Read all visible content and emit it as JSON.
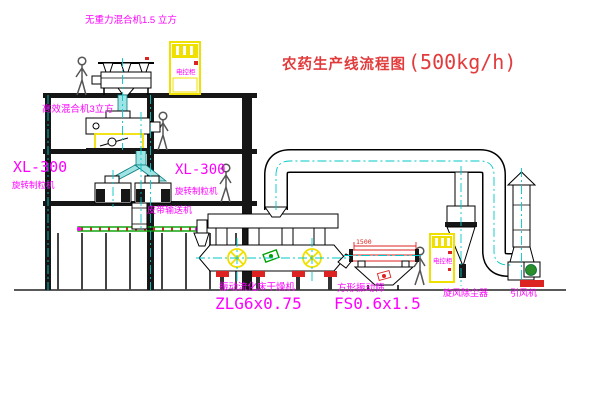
{
  "title": {
    "zh": "农药生产线流程图",
    "capacity": "(500kg/h)"
  },
  "labels": {
    "top_mixer": "无重力混合机1.5 立方",
    "floor2_mixer": "高效混合机3立方",
    "granulator1_model": "XL-300",
    "granulator1_name": "旋转制粒机",
    "granulator2_model": "XL-300",
    "granulator2_name": "旋转制粒机",
    "belt_conveyor": "皮带输送机",
    "dryer_name": "振动流化床干燥机",
    "dryer_model": "ZLG6x0.75",
    "sieve_name": "方形振动筛",
    "sieve_model": "FS0.6x1.5",
    "cyclone": "旋风除尘器",
    "fan": "引风机",
    "cabinet1": "电控柜",
    "cabinet2": "电控柜",
    "sieve_dimension": "1500"
  },
  "colors": {
    "label_magenta": "#ff00ff",
    "title_red": "#e23b3b",
    "dim_red": "#dd2222",
    "highlight_yellow": "#f0e000",
    "centerline_cyan": "#00c8c8",
    "belt_green": "#00a000"
  }
}
